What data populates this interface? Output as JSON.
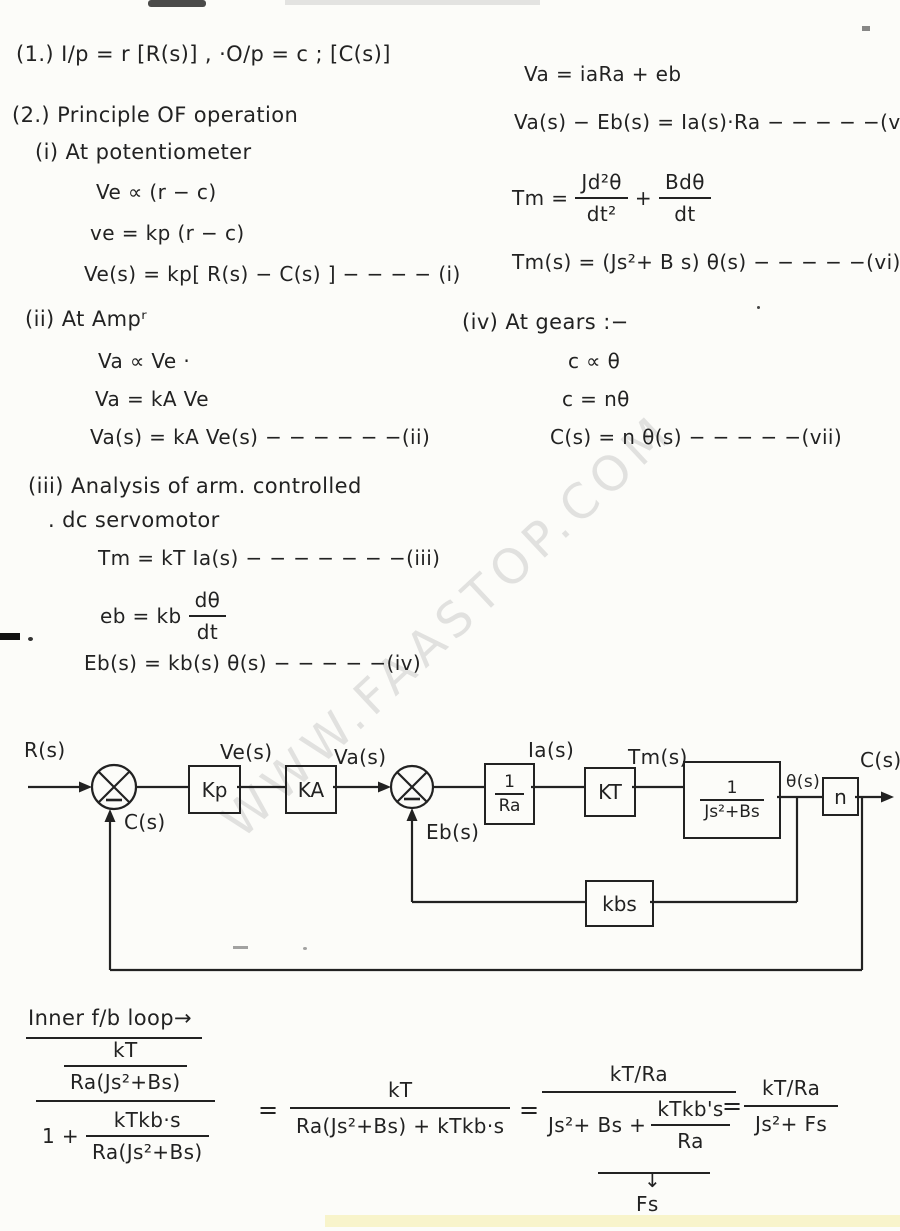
{
  "page": {
    "background": "#fcfcf9",
    "ink": "#222222",
    "watermark_color": "#c7c7c7"
  },
  "watermark": {
    "text": "WWW.FAASTOP.COM"
  },
  "notes_left": {
    "item1": "(1.)  I/p = r [R(s)]  ,   ·O/p = c ; [C(s)]",
    "item2": "(2.)  Principle OF operation",
    "pot_title": "(i) At potentiometer",
    "pot_eq1": "Ve ∝ (r − c)",
    "pot_eq2": "ve = kp (r − c)",
    "pot_eq3": "Ve(s) = kp[ R(s) − C(s) ]  − − − − (i)",
    "amp_title": "(ii) At Ampʳ",
    "amp_eq1": "Va ∝ Ve ·",
    "amp_eq2": "Va = kA Ve",
    "amp_eq3": "Va(s) = kA Ve(s)  − − − − − −(ii)",
    "servo_title1": "(iii) Analysis of arm. controlled",
    "servo_title2": ".  dc servomotor",
    "servo_eq1": "Tm = kT Ia(s) − − − − − − −(iii)",
    "servo_eq2_lhs": "eb = kb",
    "servo_eq2_num": "dθ",
    "servo_eq2_den": "dt",
    "servo_eq3": "Eb(s) =  kb(s) θ(s)  − − − − −(iv)"
  },
  "notes_right": {
    "arm_eq1": "Va = iaRa + eb",
    "arm_eq2": "Va(s) − Eb(s) = Ia(s)·Ra  − − − − −(v)",
    "torque_lhs": "Tm =",
    "torque_f1_num": "Jd²θ",
    "torque_f1_den": "dt²",
    "torque_plus": "+",
    "torque_f2_num": "Bdθ",
    "torque_f2_den": "dt",
    "torque_eq": "Tm(s) =  (Js²+ B s) θ(s)  − − − − −(vi)",
    "gears_title": "(iv)  At gears :−",
    "gears_eq1": "c ∝ θ",
    "gears_eq2": "c = nθ",
    "gears_eq3": "C(s) = n θ(s)   − − − − −(vii)"
  },
  "diagram": {
    "labels": {
      "input": "R(s)",
      "feedback": "C(s)",
      "error": "Ve(s)",
      "amp_out": "Va(s)",
      "back_emf": "Eb(s)",
      "current": "Ia(s)",
      "torque": "Tm(s)",
      "theta": "θ(s)",
      "output": "C(s)"
    },
    "blocks": {
      "kp": "Kp",
      "ka": "KA",
      "ra_num": "1",
      "ra_den": "Ra",
      "kt": "KT",
      "plant_num": "1",
      "plant_den": "Js²+Bs",
      "gear": "n",
      "kbs": "kbs"
    }
  },
  "derivation": {
    "title": "Inner f/b loop→",
    "f1_num_num": "kT",
    "f1_num_den": "Ra(Js²+Bs)",
    "f1_den_pre": "1 +",
    "f1_den_num": "kTkb·s",
    "f1_den_den": "Ra(Js²+Bs)",
    "eq1": "=",
    "f2_num": "kT",
    "f2_den": "Ra(Js²+Bs) + kTkb·s",
    "eq2": "=",
    "f3_num": "kT/Ra",
    "f3_den_pre": "Js²+ Bs +",
    "f3_den_num": "kTkb's",
    "f3_den_den": "Ra",
    "f3_arrow": "↓",
    "f3_brace_label": "Fs",
    "eq3": "=",
    "f4_num": "kT/Ra",
    "f4_den": "Js²+ Fs"
  }
}
